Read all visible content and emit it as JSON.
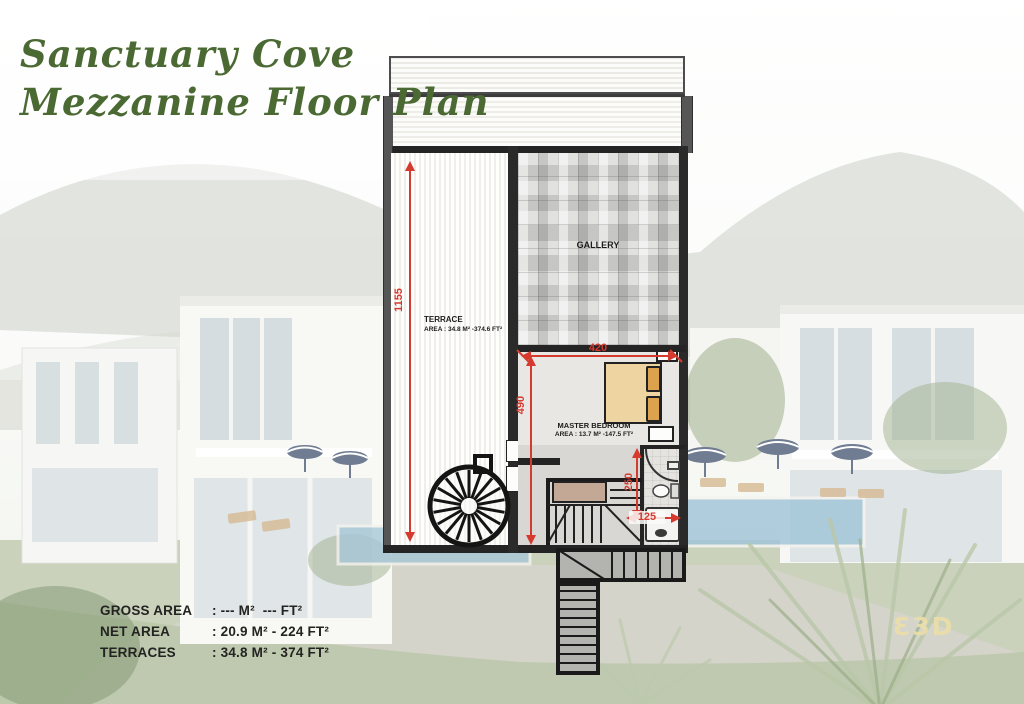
{
  "title": {
    "line1": "Sanctuary Cove",
    "line2": "Mezzanine Floor Plan"
  },
  "floor_plan": {
    "terrace": {
      "name": "TERRACE",
      "area": "AREA : 34.8 M² -374.6 FT²"
    },
    "gallery": {
      "name": "GALLERY"
    },
    "master_bedroom": {
      "name": "MASTER BEDROOM",
      "area": "AREA : 13.7 M² -147.5 FT²"
    },
    "dimensions": {
      "terrace_length": "1155",
      "bedroom_width": "420",
      "bedroom_depth": "490",
      "bathroom_length": "250",
      "bathroom_width": "125"
    }
  },
  "area_table": {
    "rows": [
      {
        "label": "GROSS AREA",
        "value": ": --- M²  --- FT²"
      },
      {
        "label": "NET AREA",
        "value": ": 20.9 M² - 224 FT²"
      },
      {
        "label": "TERRACES",
        "value": ": 34.8 M² - 374 FT²"
      }
    ]
  },
  "logo": {
    "text": "Ɛ3D"
  },
  "colors": {
    "title_green": "#4b6a33",
    "dimension_red": "#d63a2f",
    "logo_cream": "#ecdfa9"
  }
}
